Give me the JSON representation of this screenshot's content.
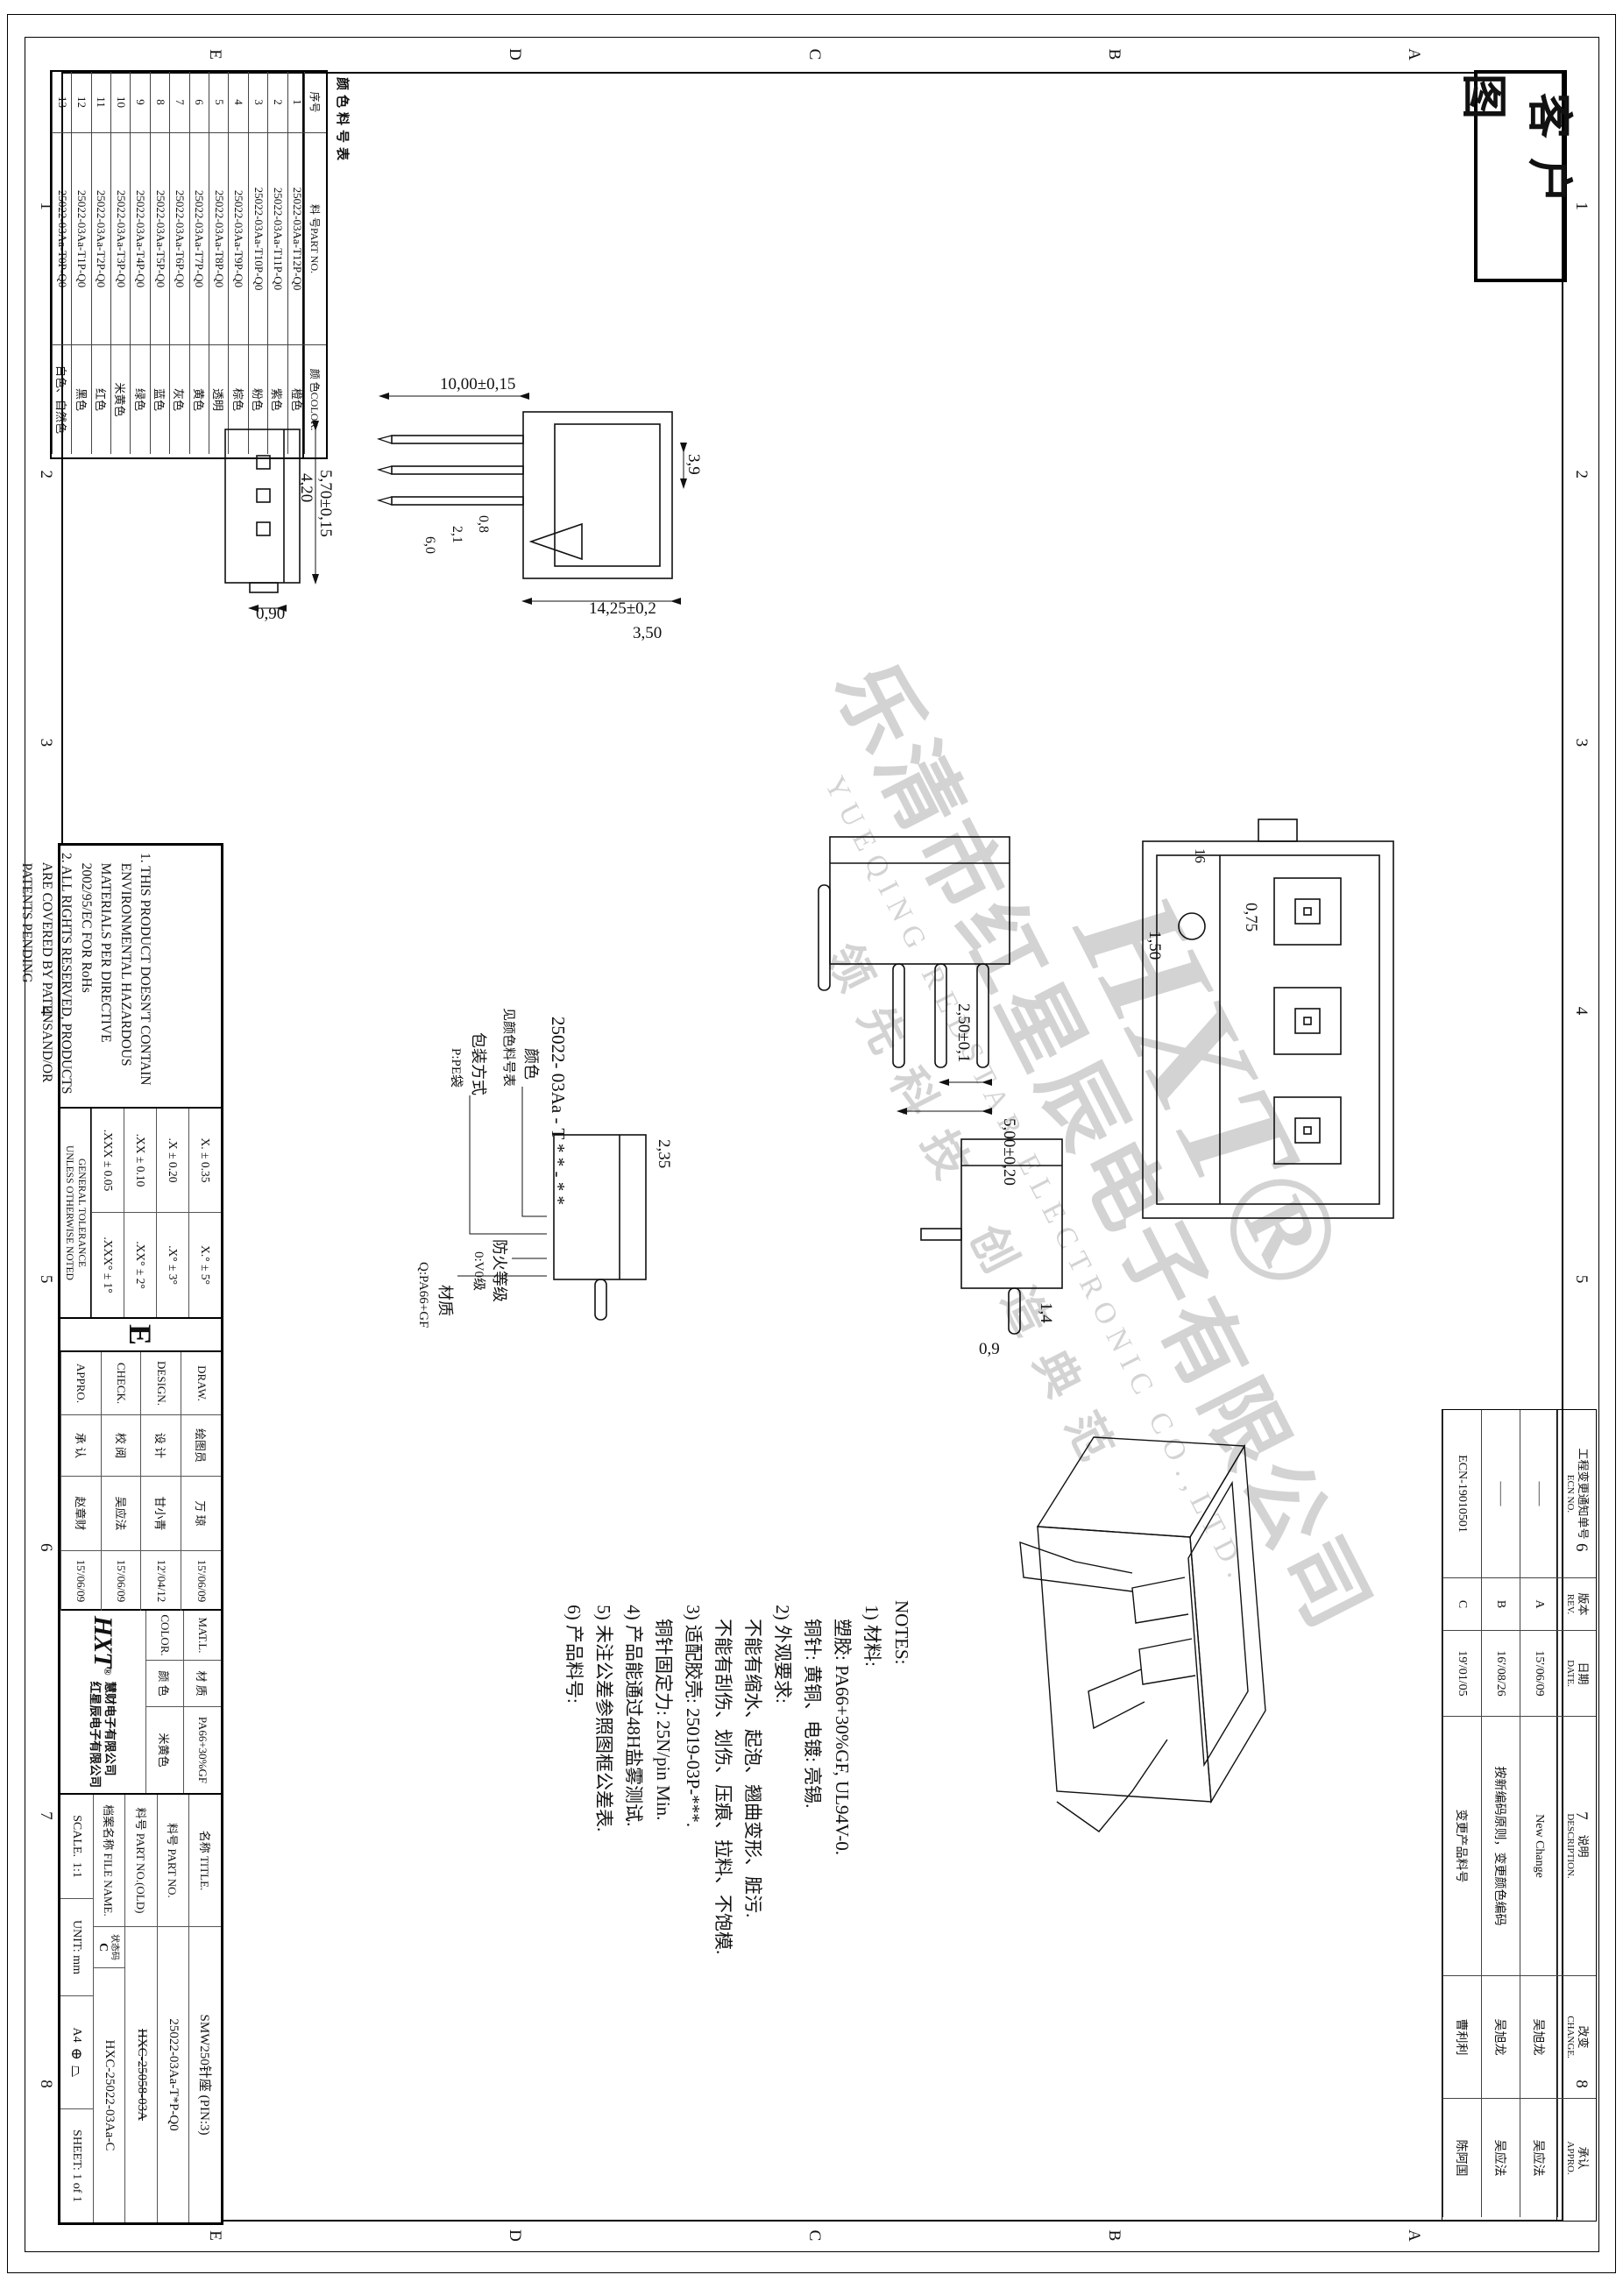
{
  "stamp": {
    "label": "客户图"
  },
  "frame": {
    "cols": [
      "1",
      "2",
      "3",
      "4",
      "5",
      "6",
      "7",
      "8"
    ],
    "rows": [
      "A",
      "B",
      "C",
      "D",
      "E"
    ]
  },
  "color_table": {
    "title": "颜色料号表",
    "headers": {
      "seq": "序号",
      "part": "料 号PART NO.",
      "color": "颜 色COLOR."
    },
    "rows": [
      {
        "no": "1",
        "part": "25022-03Aa-T12P-Q0",
        "color": "橙色"
      },
      {
        "no": "2",
        "part": "25022-03Aa-T11P-Q0",
        "color": "紫色"
      },
      {
        "no": "3",
        "part": "25022-03Aa-T10P-Q0",
        "color": "粉色"
      },
      {
        "no": "4",
        "part": "25022-03Aa-T9P-Q0",
        "color": "棕色"
      },
      {
        "no": "5",
        "part": "25022-03Aa-T8P-Q0",
        "color": "透明"
      },
      {
        "no": "6",
        "part": "25022-03Aa-T7P-Q0",
        "color": "黄色"
      },
      {
        "no": "7",
        "part": "25022-03Aa-T6P-Q0",
        "color": "灰色"
      },
      {
        "no": "8",
        "part": "25022-03Aa-T5P-Q0",
        "color": "蓝色"
      },
      {
        "no": "9",
        "part": "25022-03Aa-T4P-Q0",
        "color": "绿色"
      },
      {
        "no": "10",
        "part": "25022-03Aa-T3P-Q0",
        "color": "米黄色"
      },
      {
        "no": "11",
        "part": "25022-03Aa-T2P-Q0",
        "color": "红色"
      },
      {
        "no": "12",
        "part": "25022-03Aa-T1P-Q0",
        "color": "黑色"
      },
      {
        "no": "13",
        "part": "25022-03Aa-T0P-Q0",
        "color": "白色、自然色"
      }
    ]
  },
  "ecn_table": {
    "headers": {
      "no_cn": "工程变更通知单号",
      "no_en": "ECN NO.",
      "rev_cn": "版本",
      "rev_en": "REV.",
      "date_cn": "日期",
      "date_en": "DATE.",
      "desc_cn": "说明",
      "desc_en": "DESCRIPTION.",
      "chg_cn": "改变",
      "chg_en": "CHANGE.",
      "app_cn": "承认",
      "app_en": "APPRO."
    },
    "rows": [
      {
        "no": "——",
        "rev": "A",
        "date": "15'/06/09",
        "desc": "New Change",
        "chg": "吴旭龙",
        "app": "吴应法"
      },
      {
        "no": "——",
        "rev": "B",
        "date": "16'/08/26",
        "desc": "按新编码原则，变更颜色编码",
        "chg": "吴旭龙",
        "app": "吴应法"
      },
      {
        "no": "ECN-19010501",
        "rev": "C",
        "date": "19'/01/05",
        "desc": "变更产品料号",
        "chg": "曹利利",
        "app": "陈阿国"
      }
    ]
  },
  "notes_cn": {
    "lines": [
      "NOTES:",
      " 1) 材料:",
      "    塑胶: PA66+30%GF, UL94V-0.",
      "    铜针: 黄铜、电镀: 亮锡.",
      " 2) 外观要求:",
      "    不能有缩水、起泡、翘曲变形、脏污.",
      "    不能有刮伤、划伤、压痕、拉料、不饱模.",
      " 3) 适配胶壳: 25019-03P-***.",
      "    铜针固定力: 25N/pin Min.",
      " 4) 产品能通过48H盐雾测试.",
      " 5) 未注公差参照图框公差表.",
      " 6) 产品料号:"
    ]
  },
  "part_tree": {
    "base": "25022- 03Aa - T * * - * *",
    "b1": "颜色",
    "b1s": "见颜色料号表",
    "b2": "包装方式",
    "b2s": "P:PE袋",
    "b3": "防火等级",
    "b3s": "0:V0级",
    "b4": "材质",
    "b4s": "Q:PA66+GF"
  },
  "notes_en": {
    "lines": [
      "1. THIS PRODUCT DOESN'T CONTAIN",
      "   ENVIRONMENTAL HAZARDOUS",
      "   MATERIALS PER DIRECTIVE",
      "   2002/95/EC FOR RoHs",
      "2. ALL RIGHTS RESERVED, PRODUCTS",
      "   ARE COVERED BY PATENSAND/OR",
      "   PATENTS PENDING"
    ]
  },
  "tolerance": {
    "entries": [
      "X. ± 0.35",
      "X.° ± 5°",
      ".X ± 0.20",
      ".X° ± 3°",
      ".XX ± 0.10",
      ".XX° ± 2°",
      ".XXX ± 0.05",
      ".XXX° ± 1°"
    ],
    "caption1": "GENERAL TOLERANCE",
    "caption2": "UNLESS OTHERWISE NOTED"
  },
  "rev_letter": "E",
  "signatures": {
    "rows": [
      {
        "en": "DRAW.",
        "cn": "绘图员",
        "name": "万 琼",
        "date": "15'/06/09"
      },
      {
        "en": "DESIGN.",
        "cn": "设 计",
        "name": "甘小青",
        "date": "12'/04/12"
      },
      {
        "en": "CHECK.",
        "cn": "校 阅",
        "name": "吴应法",
        "date": "15'/06/09"
      },
      {
        "en": "APPRO.",
        "cn": "承 认",
        "name": "赵章财",
        "date": "15'/06/09"
      }
    ]
  },
  "material": {
    "mat_en": "MAT.L.",
    "mat_cn": "材 质",
    "mat_val": "PA66+30%GF",
    "col_en": "COLOR.",
    "col_cn": "颜 色",
    "col_val": "米黄色"
  },
  "company": {
    "logo": "HXT",
    "reg": "®",
    "line1": "慧财电子有限公司",
    "line2": "红星辰电子有限公司"
  },
  "title_block": {
    "name_label": "名称 TITLE.",
    "name_value": "SMW250针座  (PIN:3)",
    "part_label": "料号 PART NO.",
    "part_value": "25022-03Aa-T*P-Q0",
    "old_label": "料号 PART NO.(OLD)",
    "old_value": "HXC-25058-03A",
    "file_label": "档案名称 FILE NAME.",
    "status_label": "状态码",
    "status_value": "C",
    "file_value": "HXC-25022-03Aa-C",
    "scale_label": "SCALE.",
    "scale_value": "1:1",
    "unit": "UNIT: mm",
    "size": "A4",
    "sheet": "SHEET: 1 of 1"
  },
  "dims": {
    "v1_w": "5,70±0,15",
    "v1_wi": "4,20",
    "v1_h": "0,90",
    "v2_h": "14,25±0,2",
    "v2_d1": "3,50",
    "v2_d2": "3,9",
    "v2_pin": "10,00±0,15",
    "v2_p1": "0,8",
    "v2_p2": "2,1",
    "v2_p3": "6,0",
    "v3_d": "2,35",
    "v4_s1": "2,50±0,1",
    "v4_s2": "5,00±0,20",
    "v6_d1": "1,4",
    "v6_d2": "0,9",
    "v7_d1": "0,75",
    "v7_d2": "1,50",
    "v7_mark": "16"
  },
  "watermark": {
    "l1": "HXT",
    "l2": "乐清市红星辰电子有限公司",
    "l3": "YUEQING REDSTAR ELECTRONIC CO.,LTD.",
    "l4": "领先科技 创造典范"
  }
}
